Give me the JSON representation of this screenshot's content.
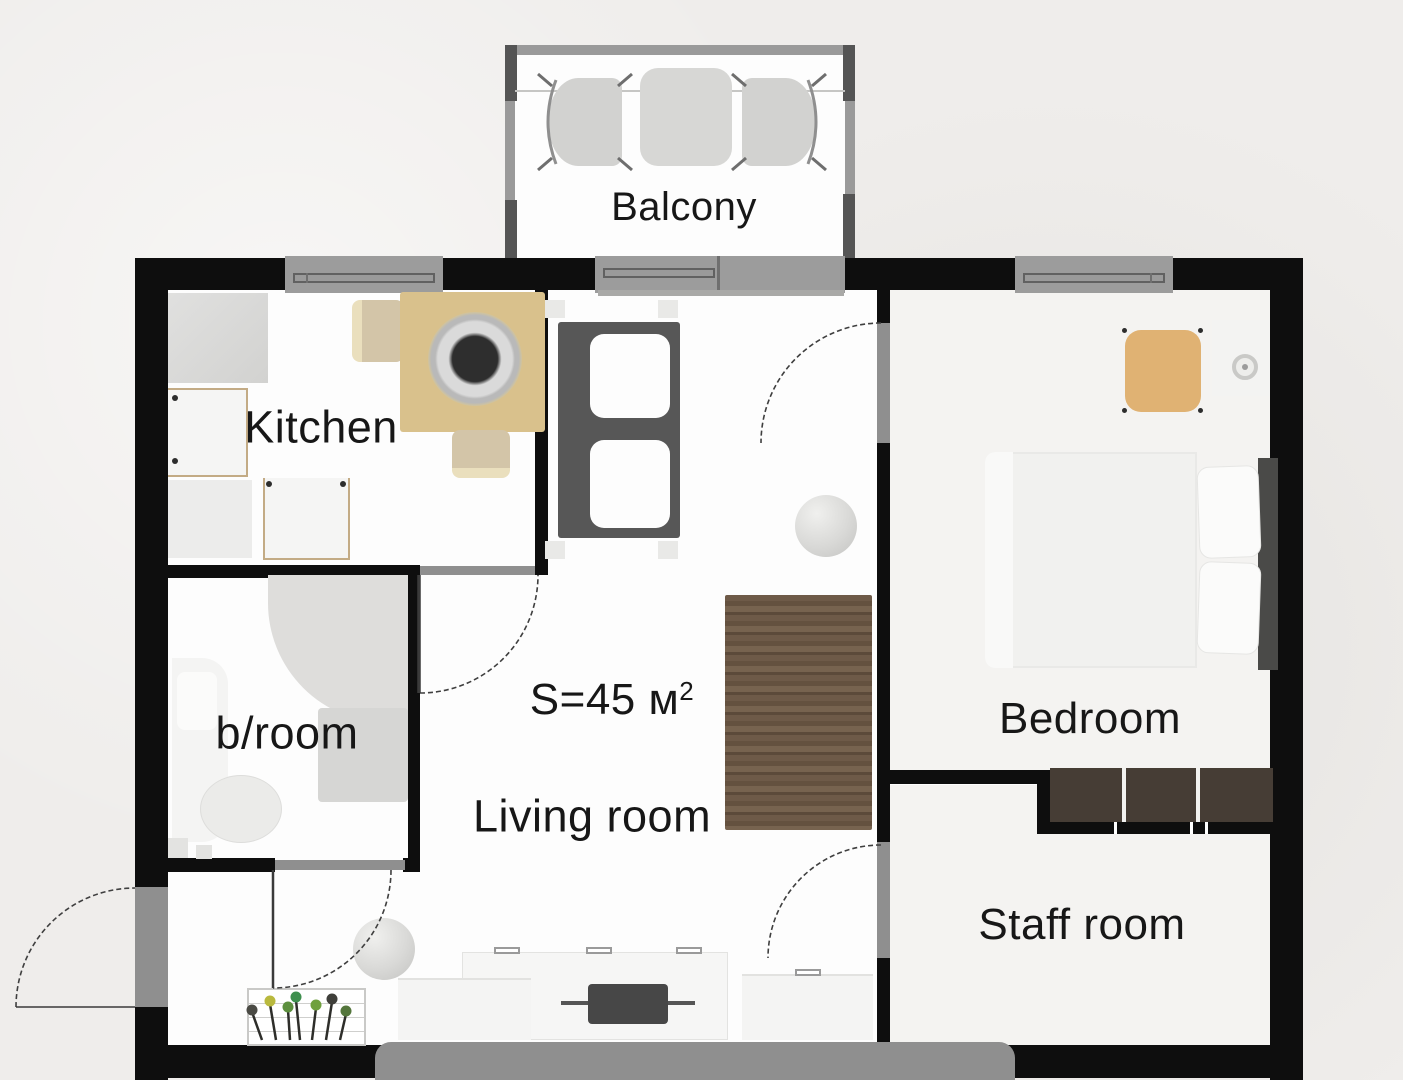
{
  "plan": {
    "rooms": [
      {
        "id": "balcony",
        "label": "Balcony"
      },
      {
        "id": "kitchen",
        "label": "Kitchen"
      },
      {
        "id": "bathroom",
        "label": "b/room"
      },
      {
        "id": "living",
        "label": "Living room"
      },
      {
        "id": "bedroom",
        "label": "Bedroom"
      },
      {
        "id": "staff",
        "label": "Staff room"
      }
    ],
    "area_label": {
      "prefix": "S=45 м",
      "superscript": "2"
    },
    "colors": {
      "wall": "#0e0e0e",
      "floor": "#fdfdfd",
      "floorAlt": "#f4f3f1",
      "background": "#efedeb",
      "windowGray": "#9c9c9c",
      "doorGray": "#8f8f8f",
      "wood": "#d9c18c",
      "wardrobeBrown": "#6b5846",
      "wardrobeDark": "#463d35",
      "chairTan": "#e0b273",
      "shelfDark": "#575757",
      "terraceGray": "#8f8f8f"
    }
  }
}
